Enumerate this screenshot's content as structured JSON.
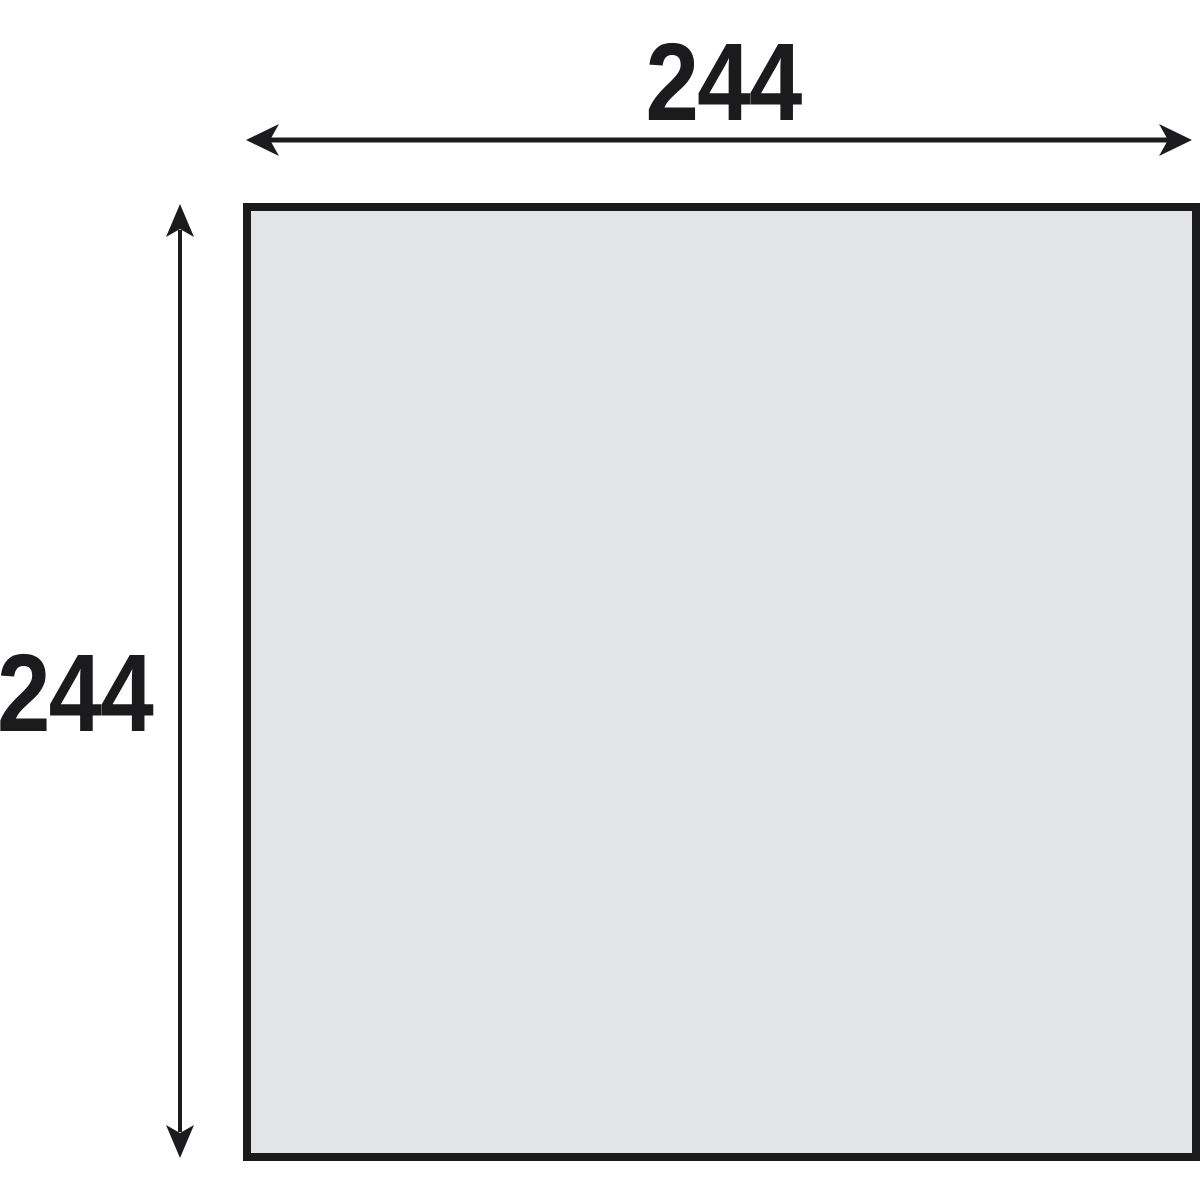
{
  "diagram": {
    "type": "dimensioned-square-drawing",
    "shape": "square",
    "width_label": "244",
    "height_label": "244",
    "width_value": 244,
    "height_value": 244,
    "colors": {
      "background": "#ffffff",
      "shape_fill": "#e3e4e6",
      "line_and_text": "#1b1b1e"
    }
  }
}
